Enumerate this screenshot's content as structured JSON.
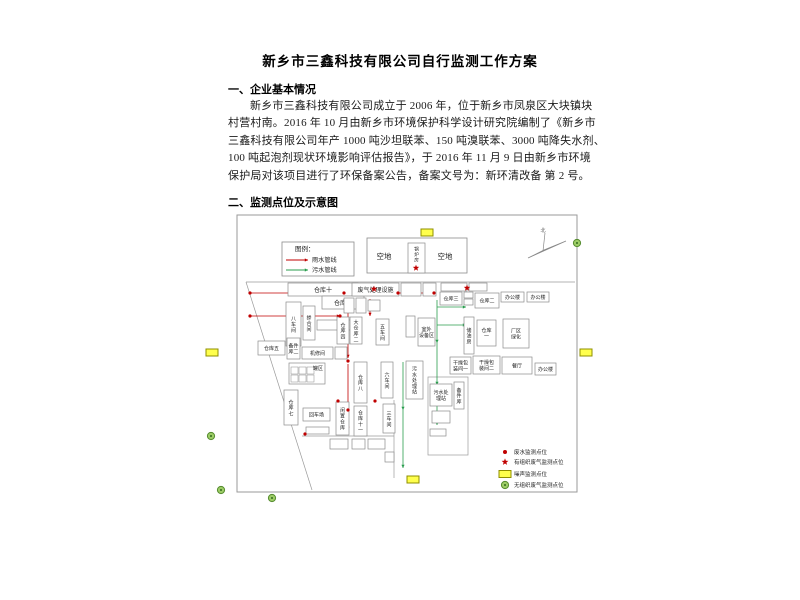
{
  "page": {
    "title": "新乡市三鑫科技有限公司自行监测工作方案",
    "section1": {
      "heading": "一、企业基本情况",
      "paragraph_lines": [
        "新乡市三鑫科技有限公司成立于 2006 年，位于新乡市凤泉区大块镇块",
        "村营村南。2016 年 10 月由新乡市环境保护科学设计研究院编制了《新乡市",
        "三鑫科技有限公司年产 1000 吨沙坦联苯、150 吨溴联苯、3000 吨降失水剂、",
        "100 吨起泡剂现状环境影响评估报告》，于 2016 年 11 月 9 日由新乡市环境",
        "保护局对该项目进行了环保备案公告，备案文号为：新环清改备  第 2 号。"
      ]
    },
    "section2": {
      "heading": "二、监测点位及示意图"
    }
  },
  "colors": {
    "rain_red": "#c00000",
    "sewage_green": "#2a9d4e",
    "noise_yellow": "#ffff4d",
    "noise_border": "#8f8f00",
    "gas_green_fill": "#9ccc65",
    "gas_green_border": "#558b2f",
    "box_border": "#8c8c8c",
    "outline": "#9a9a9a"
  },
  "diagram": {
    "border": [
      237,
      215,
      340,
      277
    ],
    "legend_top": {
      "title": "图例：",
      "box": [
        282,
        242,
        72,
        34
      ],
      "items": [
        {
          "label": "雨水管线",
          "type": "rain"
        },
        {
          "label": "污水管线",
          "type": "sewage"
        }
      ]
    },
    "legend_bottom": {
      "x": 505,
      "rows_y": [
        452,
        462,
        474,
        485
      ],
      "items": [
        {
          "marker": "dot",
          "label": "废水监测点位"
        },
        {
          "marker": "star",
          "label": "有组织废气监测点位"
        },
        {
          "marker": "noise",
          "label": "噪声监测点位"
        },
        {
          "marker": "circle",
          "label": "无组织废气监测点位"
        }
      ]
    },
    "compass_label": "北",
    "vacant": {
      "box": [
        367,
        238,
        100,
        35
      ],
      "labels": [
        {
          "t": "空地",
          "x": 384,
          "y": 259
        },
        {
          "t": "空地",
          "x": 445,
          "y": 259
        }
      ],
      "boiler": {
        "box": [
          408,
          243,
          17,
          30
        ],
        "label": "锅炉房"
      }
    },
    "areas": [
      {
        "label": "仓库十",
        "x": 288,
        "y": 283,
        "w": 70,
        "h": 13
      },
      {
        "label": "仓库九",
        "x": 322,
        "y": 296,
        "w": 42,
        "h": 13
      },
      {
        "label": "八车间",
        "x": 286,
        "y": 302,
        "w": 15,
        "h": 44,
        "v": 1
      },
      {
        "label": "掺合间",
        "x": 303,
        "y": 306,
        "w": 12,
        "h": 34,
        "v": 1
      },
      {
        "label": "",
        "x": 317,
        "y": 320,
        "w": 34,
        "h": 10
      },
      {
        "label": "仓库五",
        "x": 258,
        "y": 341,
        "w": 27,
        "h": 14
      },
      {
        "label": "备件|库二",
        "x": 287,
        "y": 338,
        "w": 13,
        "h": 21
      },
      {
        "label": "机修间",
        "x": 302,
        "y": 347,
        "w": 31,
        "h": 12
      },
      {
        "label": "",
        "x": 335,
        "y": 347,
        "w": 12,
        "h": 12
      },
      {
        "label": "罐区",
        "x": 289,
        "y": 363,
        "w": 36,
        "h": 21,
        "tank": 1
      },
      {
        "label": "仓库七",
        "x": 284,
        "y": 390,
        "w": 14,
        "h": 35,
        "v": 1
      },
      {
        "label": "回车场",
        "x": 303,
        "y": 408,
        "w": 27,
        "h": 13
      },
      {
        "label": "闲置仓库",
        "x": 336,
        "y": 402,
        "w": 13,
        "h": 33,
        "v": 1
      },
      {
        "label": "仓库八",
        "x": 354,
        "y": 362,
        "w": 13,
        "h": 41,
        "v": 1
      },
      {
        "label": "仓库十一",
        "x": 354,
        "y": 406,
        "w": 13,
        "h": 30,
        "v": 1
      },
      {
        "label": "废气处理设施",
        "x": 352,
        "y": 283,
        "w": 47,
        "h": 13
      },
      {
        "label": "",
        "x": 344,
        "y": 298,
        "w": 10,
        "h": 15
      },
      {
        "label": "",
        "x": 356,
        "y": 298,
        "w": 10,
        "h": 15
      },
      {
        "label": "",
        "x": 368,
        "y": 300,
        "w": 12,
        "h": 11
      },
      {
        "label": "仓库四",
        "x": 337,
        "y": 317,
        "w": 12,
        "h": 27,
        "v": 1
      },
      {
        "label": "大仓库二",
        "x": 350,
        "y": 317,
        "w": 12,
        "h": 27,
        "v": 1
      },
      {
        "label": "五车间",
        "x": 376,
        "y": 319,
        "w": 13,
        "h": 26,
        "v": 1
      },
      {
        "label": "",
        "x": 406,
        "y": 316,
        "w": 9,
        "h": 21
      },
      {
        "label": "室外|设备区",
        "x": 418,
        "y": 318,
        "w": 17,
        "h": 28
      },
      {
        "label": "六车间",
        "x": 381,
        "y": 362,
        "w": 12,
        "h": 36,
        "v": 1
      },
      {
        "label": "三车间",
        "x": 383,
        "y": 404,
        "w": 12,
        "h": 29,
        "v": 1
      },
      {
        "label": "污水处理站",
        "x": 406,
        "y": 361,
        "w": 17,
        "h": 38,
        "v": 1
      },
      {
        "label": "",
        "x": 401,
        "y": 283,
        "w": 20,
        "h": 13
      },
      {
        "label": "",
        "x": 423,
        "y": 283,
        "w": 13,
        "h": 13
      },
      {
        "label": "",
        "x": 441,
        "y": 283,
        "w": 26,
        "h": 8
      },
      {
        "label": "",
        "x": 469,
        "y": 283,
        "w": 18,
        "h": 8
      },
      {
        "label": "仓库三",
        "x": 440,
        "y": 292,
        "w": 22,
        "h": 13
      },
      {
        "label": "",
        "x": 464,
        "y": 292,
        "w": 9,
        "h": 6
      },
      {
        "label": "",
        "x": 464,
        "y": 299,
        "w": 9,
        "h": 6
      },
      {
        "label": "仓库二",
        "x": 475,
        "y": 293,
        "w": 24,
        "h": 15
      },
      {
        "label": "办公楼",
        "x": 501,
        "y": 292,
        "w": 23,
        "h": 10
      },
      {
        "label": "办公楼",
        "x": 527,
        "y": 292,
        "w": 22,
        "h": 10
      },
      {
        "label": "储油房",
        "x": 464,
        "y": 317,
        "w": 10,
        "h": 37,
        "v": 1
      },
      {
        "label": "仓库|一",
        "x": 477,
        "y": 320,
        "w": 19,
        "h": 26
      },
      {
        "label": "厂区|绿化",
        "x": 503,
        "y": 319,
        "w": 26,
        "h": 29
      },
      {
        "label": "干燥包|装间一",
        "x": 450,
        "y": 357,
        "w": 21,
        "h": 17
      },
      {
        "label": "干燥包|装间二",
        "x": 473,
        "y": 356,
        "w": 27,
        "h": 18
      },
      {
        "label": "餐厅",
        "x": 502,
        "y": 357,
        "w": 30,
        "h": 17
      },
      {
        "label": "办公楼",
        "x": 535,
        "y": 363,
        "w": 21,
        "h": 12
      },
      {
        "label": "污水处|理站",
        "x": 430,
        "y": 384,
        "w": 22,
        "h": 22
      },
      {
        "label": "备件库",
        "x": 454,
        "y": 382,
        "w": 10,
        "h": 27,
        "v": 1
      },
      {
        "label": "",
        "x": 432,
        "y": 411,
        "w": 18,
        "h": 12
      },
      {
        "label": "",
        "x": 430,
        "y": 429,
        "w": 16,
        "h": 7
      },
      {
        "label": "",
        "x": 330,
        "y": 439,
        "w": 18,
        "h": 10
      },
      {
        "label": "",
        "x": 352,
        "y": 439,
        "w": 13,
        "h": 10
      },
      {
        "label": "",
        "x": 368,
        "y": 439,
        "w": 17,
        "h": 10
      },
      {
        "label": "",
        "x": 385,
        "y": 452,
        "w": 9,
        "h": 10
      },
      {
        "label": "",
        "x": 306,
        "y": 427,
        "w": 23,
        "h": 7
      }
    ],
    "outline_lines": [
      [
        246,
        282,
        575,
        282
      ],
      [
        246,
        282,
        312,
        490
      ],
      [
        302,
        436,
        394,
        436
      ],
      [
        394,
        400,
        394,
        478
      ]
    ],
    "outline_rects": [
      [
        428,
        377,
        40,
        78
      ]
    ],
    "pipes": {
      "red": [
        [
          250,
          293,
          344,
          293
        ],
        [
          398,
          293,
          434,
          293
        ],
        [
          250,
          316,
          340,
          316
        ],
        [
          348,
          299,
          348,
          358
        ],
        [
          348,
          364,
          348,
          430
        ],
        [
          370,
          299,
          370,
          316
        ]
      ],
      "green": [
        [
          437,
          300,
          437,
          343
        ],
        [
          437,
          343,
          437,
          385
        ],
        [
          437,
          385,
          437,
          425
        ],
        [
          437,
          307,
          466,
          307
        ],
        [
          437,
          325,
          466,
          325
        ],
        [
          403,
          362,
          403,
          410
        ],
        [
          403,
          410,
          403,
          468
        ]
      ]
    },
    "markers": {
      "stars": [
        [
          416,
          268
        ],
        [
          374,
          289
        ],
        [
          467,
          288
        ]
      ],
      "dots": [
        [
          250,
          293
        ],
        [
          344,
          293
        ],
        [
          398,
          293
        ],
        [
          434,
          293
        ],
        [
          250,
          316
        ],
        [
          340,
          316
        ],
        [
          348,
          361
        ],
        [
          348,
          410
        ],
        [
          338,
          401
        ],
        [
          375,
          401
        ],
        [
          305,
          434
        ]
      ],
      "noise": [
        [
          421,
          229
        ],
        [
          206,
          349
        ],
        [
          580,
          349
        ],
        [
          407,
          476
        ]
      ],
      "circles": [
        [
          577,
          243
        ],
        [
          211,
          436
        ],
        [
          221,
          490
        ],
        [
          272,
          498
        ]
      ]
    }
  }
}
